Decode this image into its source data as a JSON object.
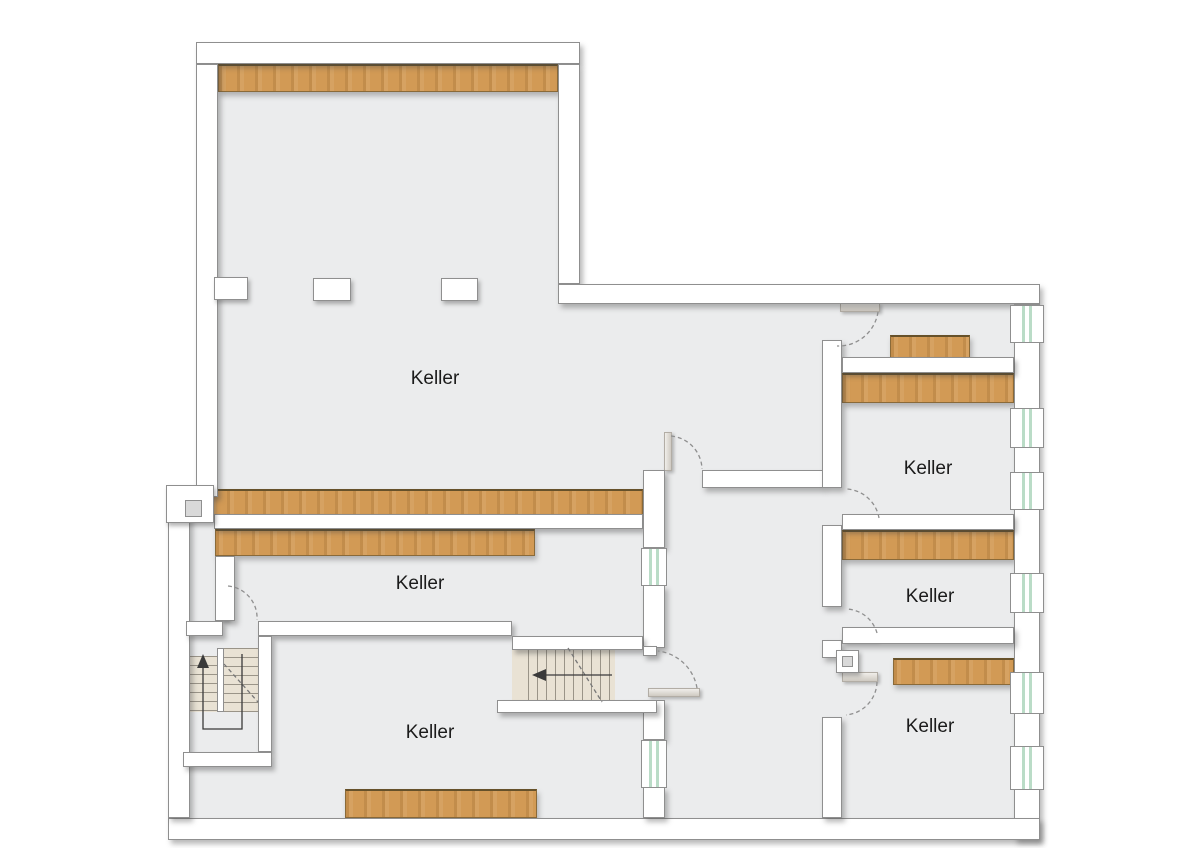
{
  "rooms": [
    {
      "id": "cellar-main",
      "label": "Keller"
    },
    {
      "id": "cellar-middle",
      "label": "Keller"
    },
    {
      "id": "cellar-bottom-left",
      "label": "Keller"
    },
    {
      "id": "cellar-right-upper",
      "label": "Keller"
    },
    {
      "id": "cellar-right-middle",
      "label": "Keller"
    },
    {
      "id": "cellar-right-lower",
      "label": "Keller"
    }
  ],
  "stairs": [
    {
      "id": "u-stair",
      "direction_icon": "up-arrow"
    },
    {
      "id": "straight-stair",
      "direction_icon": "left-arrow"
    }
  ],
  "colors": {
    "background": "#ffffff",
    "floor": "#ebeced",
    "wall_fill": "#ffffff",
    "wall_outline": "#8f8f8f",
    "wood_beam": "#d29a55",
    "wood_edge": "#7c5e31",
    "window_glass": "#badcc7",
    "stair_tread": "#e9e2d4",
    "door_swing_dash": "#8f8f8f",
    "walk_line": "#3a3a3a",
    "room_label": "#1b1b1b"
  }
}
